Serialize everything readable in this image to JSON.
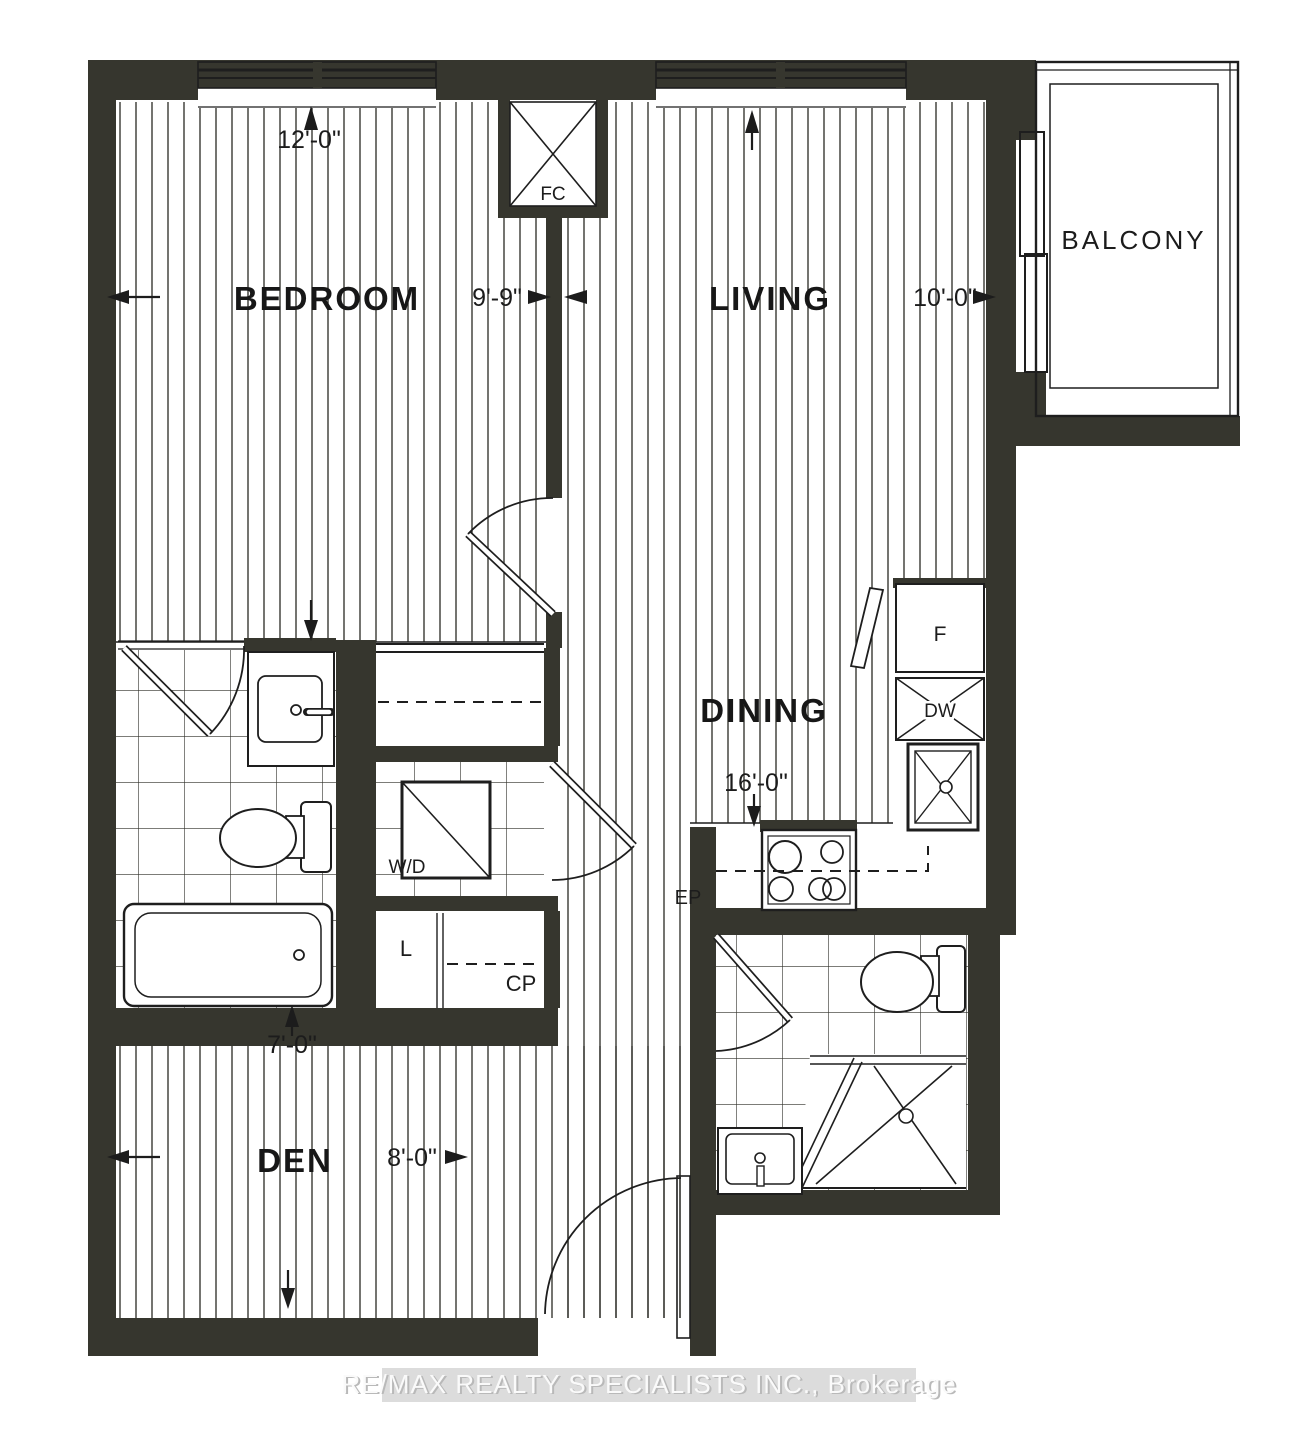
{
  "watermark": "RE/MAX REALTY SPECIALISTS INC., Brokerage",
  "colors": {
    "wall": "#36362e",
    "line": "#1e1e1e",
    "hatch": "#30302b",
    "tile": "#2d2d28",
    "label": "#171717",
    "dim": "#1c1c1c",
    "band": "#dcdcdc",
    "wm_text": "#fafafa",
    "wm_shadow": "#b9b9b9"
  },
  "rooms": {
    "bedroom": {
      "name": "BEDROOM",
      "depth": "12'-0\"",
      "width": "9'-9\""
    },
    "living": {
      "name": "LIVING",
      "width": "10'-0\""
    },
    "dining": {
      "name": "DINING",
      "length": "16'-0\""
    },
    "den": {
      "name": "DEN",
      "depth": "7'-0\"",
      "width": "8'-0\""
    },
    "balcony": {
      "name": "BALCONY"
    }
  },
  "fixtures": {
    "fan_coil": "FC",
    "washer_dryer": "W/D",
    "fridge": "F",
    "dishwasher": "DW",
    "linen_closet": "L",
    "coat_closet": "CP",
    "electrical_panel": "EP"
  }
}
